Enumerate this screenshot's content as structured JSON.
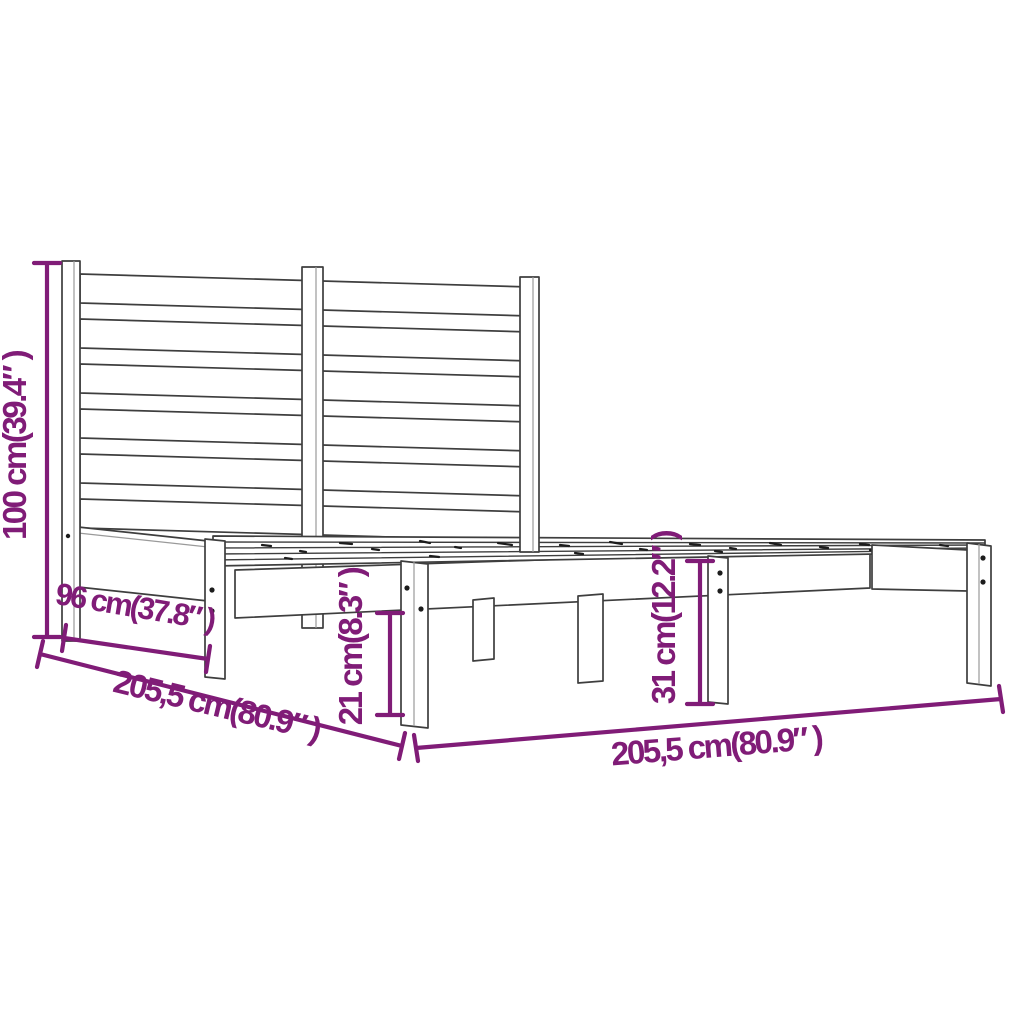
{
  "diagram": {
    "type": "product-dimension-diagram",
    "subject": "wooden bed frame with slatted base and horizontal-board headboard",
    "colors": {
      "dimension_annotation": "#801c77",
      "outline": "#3e3e3e",
      "background": "#ffffff"
    },
    "dimensions": [
      {
        "id": "headboard-height",
        "label": "100 cm(39.4″ )",
        "value_cm": "100",
        "value_in": "39.4",
        "orientation": "vertical-left"
      },
      {
        "id": "bed-width",
        "label": "96 cm(37.8″ )",
        "value_cm": "96",
        "value_in": "37.8",
        "orientation": "diagonal-head-end"
      },
      {
        "id": "bed-length-left",
        "label": "205,5 cm(80.9″ )",
        "value_cm": "205,5",
        "value_in": "80.9",
        "orientation": "diagonal-lower-left"
      },
      {
        "id": "under-bed-clearance",
        "label": "21 cm(8.3″ )",
        "value_cm": "21",
        "value_in": "8.3",
        "orientation": "vertical-center"
      },
      {
        "id": "base-height",
        "label": "31 cm(12.2″ )",
        "value_cm": "31",
        "value_in": "12.2",
        "orientation": "vertical-right"
      },
      {
        "id": "bed-length-bottom",
        "label": "205,5 cm(80.9″ )",
        "value_cm": "205,5",
        "value_in": "80.9",
        "orientation": "horizontal-bottom"
      }
    ]
  }
}
